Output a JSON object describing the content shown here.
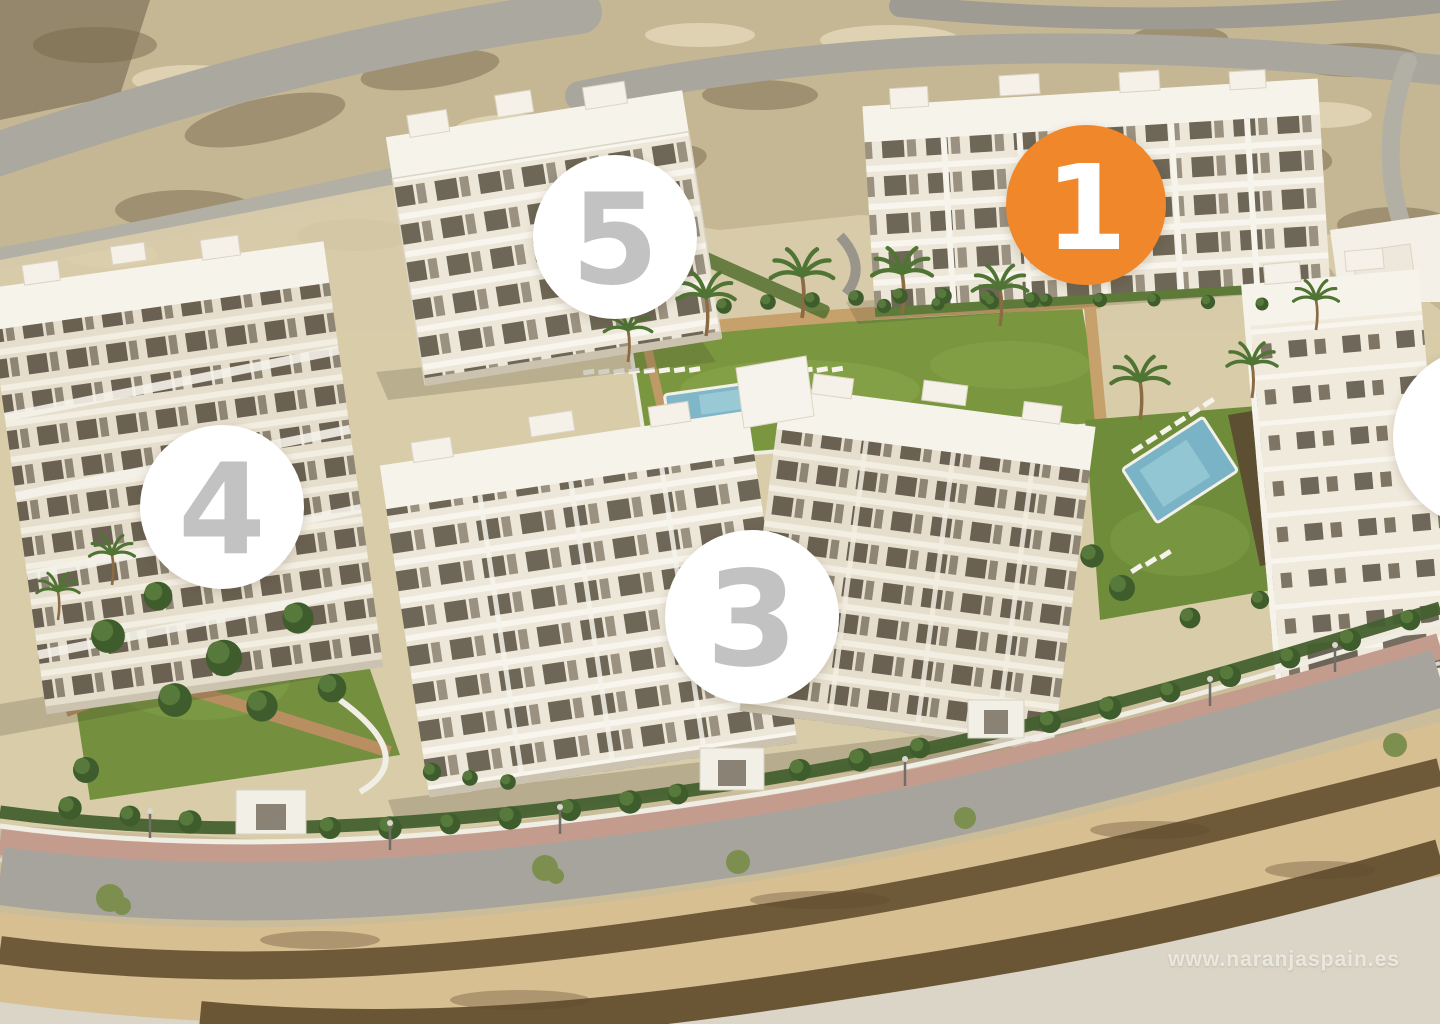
{
  "page": {
    "watermark": "www.naranjaspain.es"
  },
  "badges": {
    "b1": {
      "label": "1",
      "fill": "#F0882B",
      "text": "#FFFFFF"
    },
    "b2": {
      "label": "",
      "fill": "#FFFFFF",
      "text": "#C2C2C2"
    },
    "b3": {
      "label": "3",
      "fill": "#FFFFFF",
      "text": "#C2C2C2"
    },
    "b4": {
      "label": "4",
      "fill": "#FFFFFF",
      "text": "#C2C2C2"
    },
    "b5": {
      "label": "5",
      "fill": "#FFFFFF",
      "text": "#C2C2C2"
    }
  },
  "colors": {
    "accent_orange": "#F0882B",
    "badge_number_gray": "#C2C2C2",
    "sand": "#CBBD9A",
    "lawn_green": "#7A973F",
    "pool_blue": "#7FB6C8",
    "building_white": "#F6F3EB",
    "road_gray": "#A7A49D"
  }
}
